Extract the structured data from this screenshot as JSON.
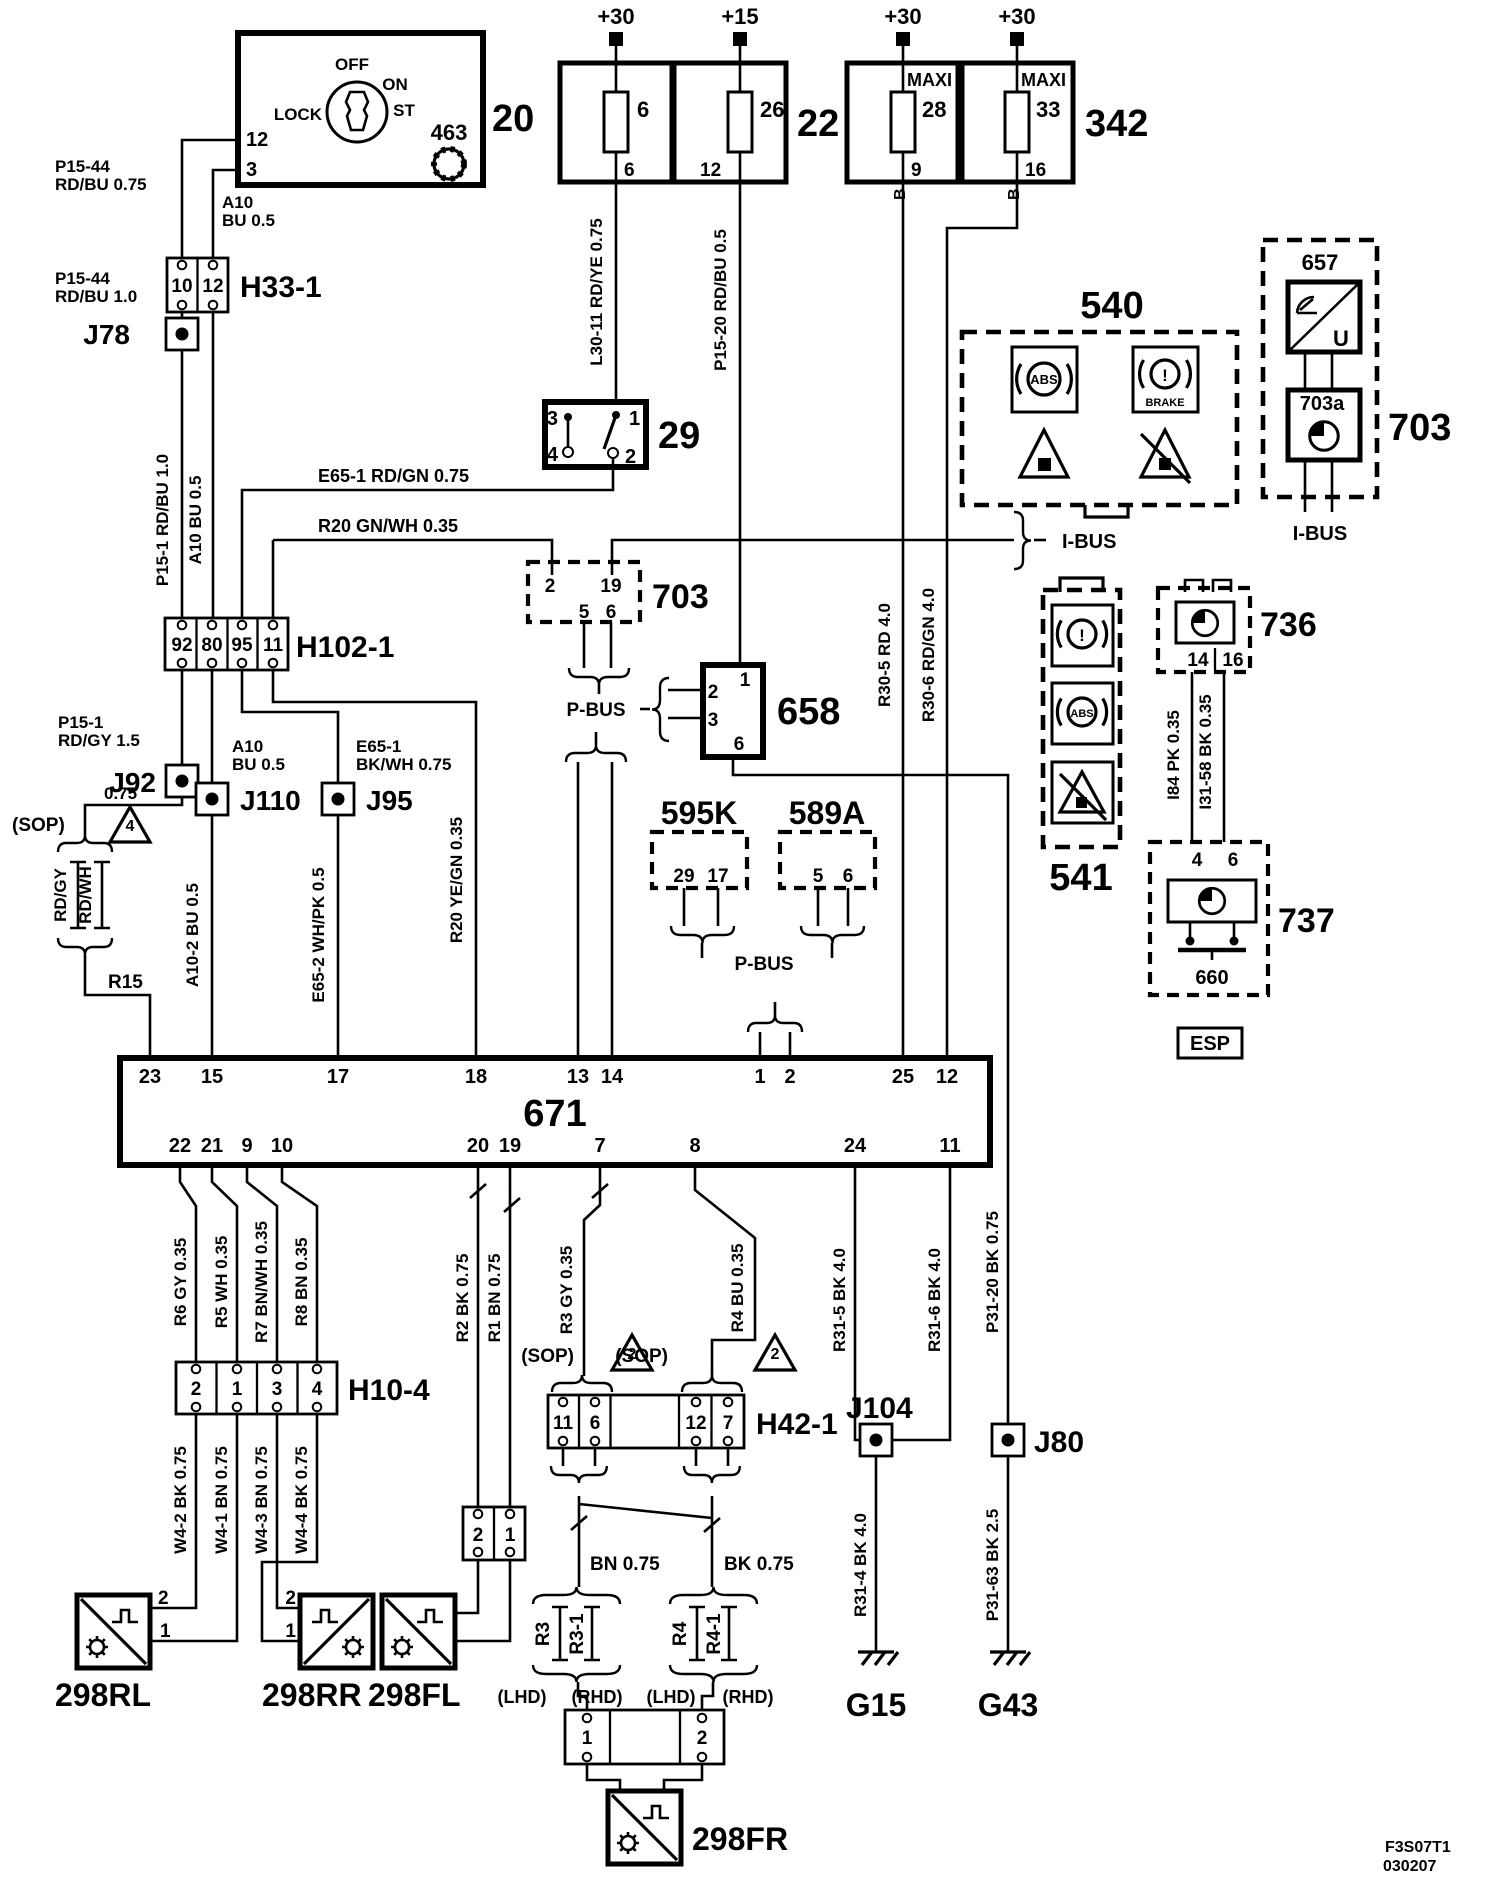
{
  "power": {
    "p30": "+30",
    "p15": "+15"
  },
  "fuse22": {
    "id": "22",
    "f1": "6",
    "f1pin": "6",
    "f2": "26",
    "f2pin": "12"
  },
  "fuse342": {
    "id": "342",
    "maxi": "MAXI",
    "f1": "28",
    "f1pin": "9",
    "f2": "33",
    "f2pin": "16",
    "b": "B"
  },
  "ignition": {
    "id": "20",
    "lock": "LOCK",
    "off": "OFF",
    "on": "ON",
    "st": "ST",
    "sym": "463",
    "pin12": "12",
    "pin3": "3"
  },
  "wires": {
    "p1544a": "P15-44",
    "p1544b": "RD/BU  0.75",
    "a10a": "A10",
    "a10b": "BU  0.5",
    "p1544c": "P15-44",
    "p1544d": "RD/BU  1.0",
    "p151v": "P15-1  RD/BU  1.0",
    "a10v": "A10  BU  0.5",
    "l3011": "L30-11  RD/YE  0.75",
    "p1520": "P15-20  RD/BU  0.5",
    "e651": "E65-1  RD/GN  0.75",
    "r20a": "R20  GN/WH  0.35",
    "p151a": "P15-1",
    "p151b": "RD/GY 1.5",
    "q075": "0.75",
    "rdgy": "RD/GY",
    "rdwh": "RD/WH",
    "r15": "R15",
    "a10c": "A10",
    "a10d": "BU  0.5",
    "e651a": "E65-1",
    "e651b": "BK/WH  0.75",
    "a102": "A10-2  BU  0.5",
    "e652": "E65-2  WH/PK  0.5",
    "r20b": "R20  YE/GN  0.35",
    "r305": "R30-5  RD  4.0",
    "r306": "R30-6  RD/GN  4.0",
    "i84": "I84  PK  0.35",
    "i3158": "I31-58  BK  0.35",
    "r6": "R6  GY  0.35",
    "r5": "R5  WH  0.35",
    "r7": "R7  BN/WH  0.35",
    "r8": "R8  BN  0.35",
    "w42": "W4-2  BK  0.75",
    "w41": "W4-1  BN  0.75",
    "w43": "W4-3  BN  0.75",
    "w44": "W4-4  BK  0.75",
    "r2": "R2  BK  0.75",
    "r1": "R1  BN  0.75",
    "r3": "R3  GY  0.35",
    "r4": "R4  BU  0.35",
    "bn075": "BN   0.75",
    "bk075": "BK   0.75",
    "r315": "R31-5  BK  4.0",
    "r316": "R31-6  BK  4.0",
    "r314": "R31-4  BK  4.0",
    "p3120": "P31-20  BK  0.75",
    "p3163": "P31-63  BK  2.5"
  },
  "h33": {
    "id": "H33-1",
    "p1": "10",
    "p2": "12"
  },
  "h102": {
    "id": "H102-1",
    "p1": "92",
    "p2": "80",
    "p3": "95",
    "p4": "11"
  },
  "sw29": {
    "id": "29",
    "p1": "3",
    "p2": "4",
    "p3": "1",
    "p4": "2"
  },
  "c703": {
    "id": "703",
    "p1": "2",
    "p2": "19",
    "p3": "5",
    "p4": "6"
  },
  "u658": {
    "id": "658",
    "p1": "1",
    "p2": "2",
    "p3": "3",
    "p4": "6"
  },
  "u595k": {
    "id": "595K",
    "p1": "29",
    "p2": "17"
  },
  "u589a": {
    "id": "589A",
    "p1": "5",
    "p2": "6"
  },
  "u540": {
    "id": "540"
  },
  "u541": {
    "id": "541"
  },
  "u703": {
    "id": "703",
    "s657": "657",
    "s703a": "703a",
    "u": "U"
  },
  "u736": {
    "id": "736",
    "p1": "14",
    "p2": "16"
  },
  "u737": {
    "id": "737",
    "p1": "4",
    "p2": "6",
    "gnd": "660",
    "esp": "ESP"
  },
  "u671": {
    "id": "671",
    "t": [
      "23",
      "15",
      "17",
      "18",
      "13",
      "14",
      "1",
      "2",
      "25",
      "12"
    ],
    "b": [
      "22",
      "21",
      "9",
      "10",
      "20",
      "19",
      "7",
      "8",
      "24",
      "11"
    ]
  },
  "h104": {
    "id": "H10-4",
    "p1": "2",
    "p2": "1",
    "p3": "3",
    "p4": "4"
  },
  "h421": {
    "id": "H42-1",
    "p1": "11",
    "p2": "6",
    "p3": "12",
    "p4": "7"
  },
  "c21": {
    "p1": "2",
    "p2": "1"
  },
  "c12": {
    "p1": "1",
    "p2": "2"
  },
  "jb": {
    "j78": "J78",
    "j92": "J92",
    "j110": "J110",
    "j95": "J95",
    "j104": "J104",
    "j80": "J80"
  },
  "sens": {
    "rl": "298RL",
    "rr": "298RR",
    "fl": "298FL",
    "fr": "298FR",
    "p2": "2",
    "p1": "1"
  },
  "bus": {
    "pbus": "P-BUS",
    "ibus": "I-BUS"
  },
  "misc": {
    "sop": "(SOP)",
    "t4": "4",
    "t2": "2",
    "lhd": "(LHD)",
    "rhd": "(RHD)",
    "abs": "ABS",
    "brake": "BRAKE",
    "ex": "!",
    "g15": "G15",
    "g43": "G43",
    "f1": "F3S07T1",
    "f2": "030207"
  }
}
